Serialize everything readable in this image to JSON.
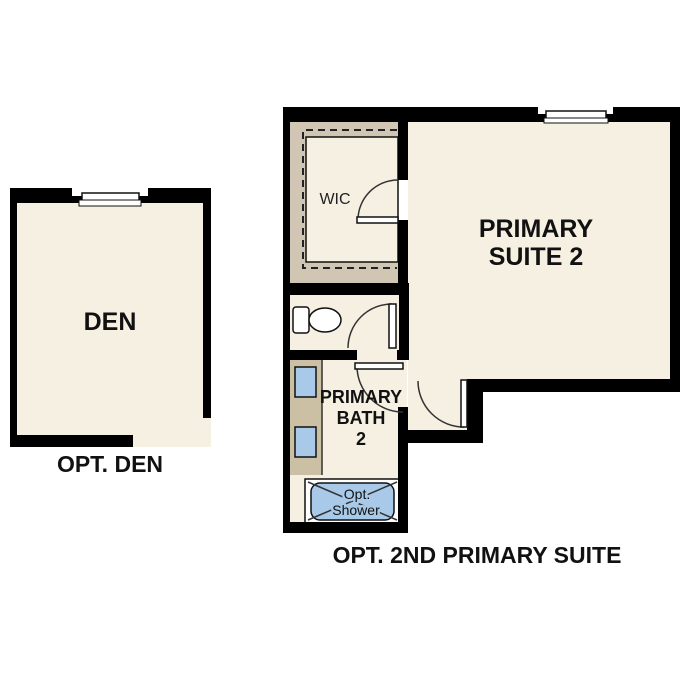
{
  "page_title": "Optional rooms floor plan",
  "plans": {
    "den": {
      "room_label": "DEN",
      "caption": "OPT. DEN"
    },
    "suite": {
      "caption": "OPT. 2ND PRIMARY SUITE",
      "wic_label": "WIC",
      "suite_label_line1": "PRIMARY",
      "suite_label_line2": "SUITE 2",
      "bath_label_line1": "PRIMARY",
      "bath_label_line2": "BATH",
      "bath_label_line3": "2",
      "shower_label_line1": "Opt.",
      "shower_label_line2": "Shower"
    }
  },
  "colors": {
    "wall": "#000000",
    "floor": "#F6F0E3",
    "closet_tan": "#D0C6B3",
    "counter_tan": "#CBBFA4",
    "fixture_blue": "#A9C9E9",
    "text": "#111111",
    "background": "#FFFFFF"
  }
}
